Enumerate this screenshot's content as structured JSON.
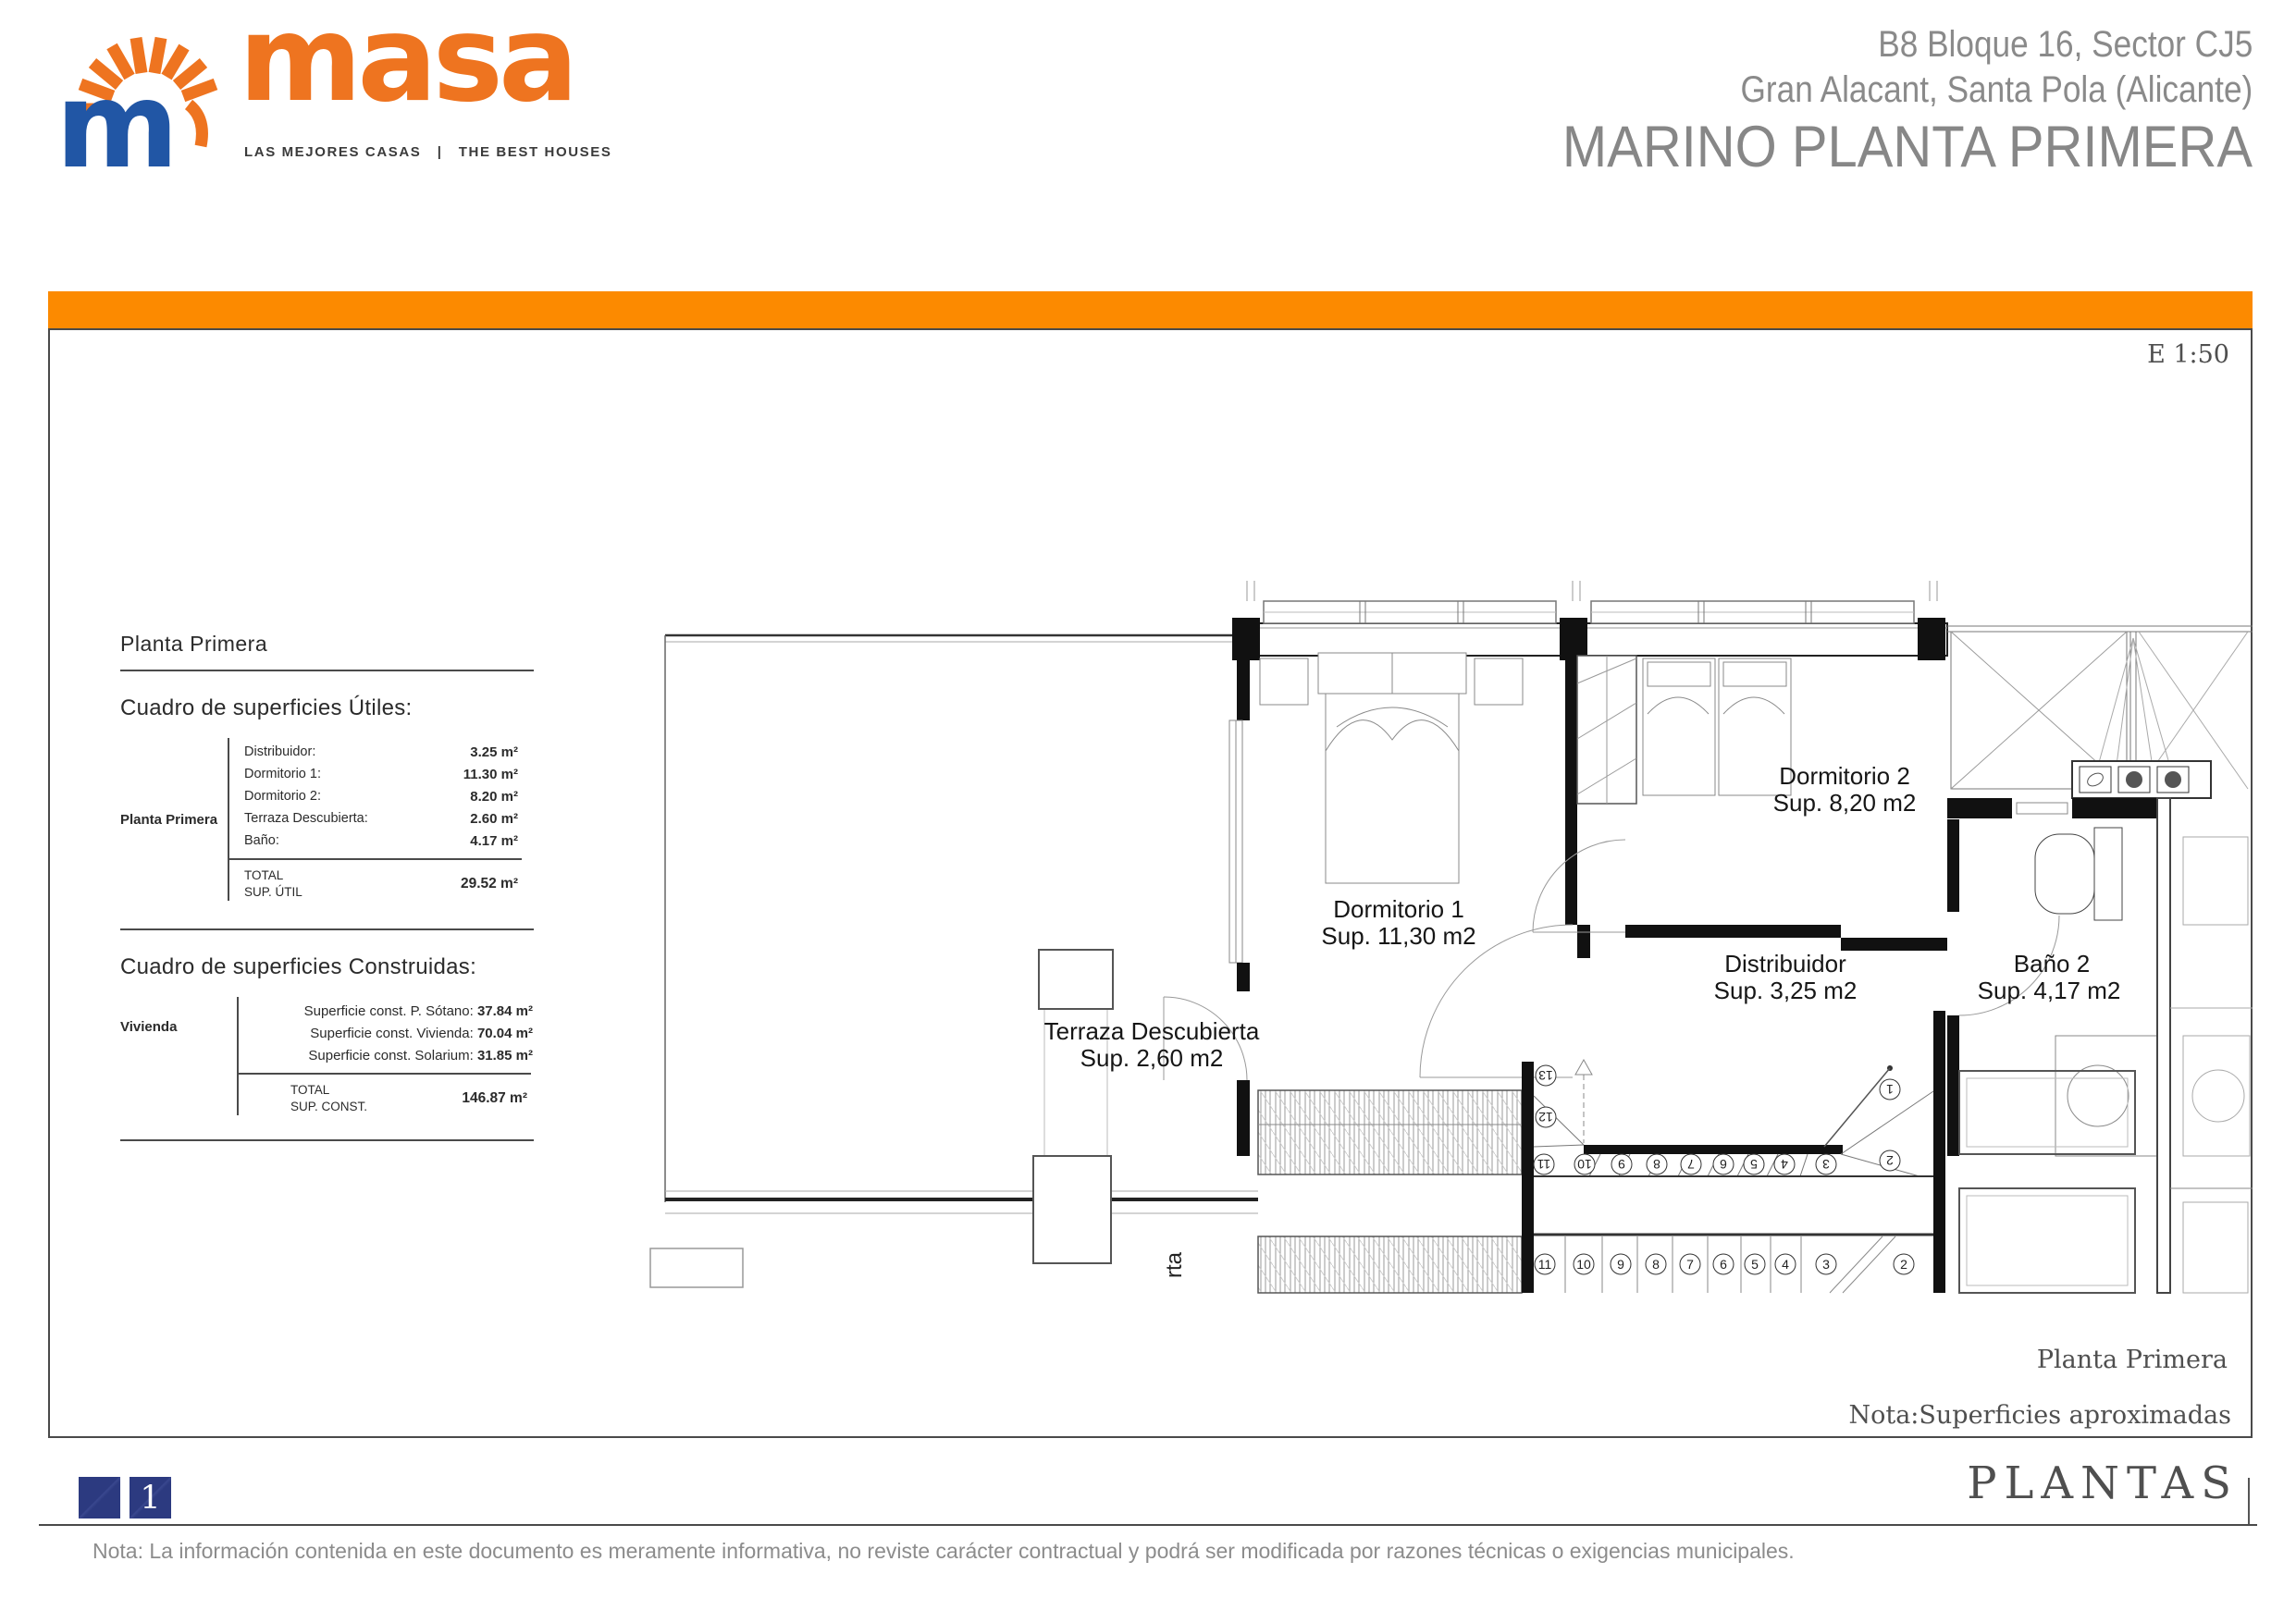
{
  "header": {
    "brand": "masa",
    "tagline": "LAS MEJORES CASAS   |   THE BEST HOUSES",
    "project_line1": "B8 Bloque 16, Sector CJ5",
    "project_line2": "Gran Alacant, Santa Pola (Alicante)",
    "project_line3": "MARINO PLANTA PRIMERA"
  },
  "sheet": {
    "scale": "E 1:50",
    "panel": {
      "title": "Planta Primera",
      "useful": {
        "heading": "Cuadro de superficies Útiles:",
        "group_label": "Planta Primera",
        "rows": [
          {
            "label": "Distribuidor:",
            "value": "3.25 m²"
          },
          {
            "label": "Dormitorio 1:",
            "value": "11.30 m²"
          },
          {
            "label": "Dormitorio 2:",
            "value": "8.20 m²"
          },
          {
            "label": "Terraza Descubierta:",
            "value": "2.60 m²"
          },
          {
            "label": "Baño:",
            "value": "4.17 m²"
          }
        ],
        "total_label": "TOTAL",
        "total_sub": "SUP. ÚTIL",
        "total_value": "29.52 m²"
      },
      "built": {
        "heading": "Cuadro de superficies Construidas:",
        "group_label": "Vivienda",
        "rows": [
          {
            "label": "Superficie const. P. Sótano: ",
            "value": "37.84 m²"
          },
          {
            "label": "Superficie const. Vivienda: ",
            "value": "70.04 m²"
          },
          {
            "label": "Superficie const. Solarium: ",
            "value": "31.85 m²"
          }
        ],
        "total_label": "TOTAL",
        "total_sub": "SUP. CONST.",
        "total_value": "146.87 m²"
      }
    },
    "plan": {
      "rooms": {
        "dormitorio1": {
          "name": "Dormitorio 1",
          "area": "Sup. 11,30 m2"
        },
        "dormitorio2": {
          "name": "Dormitorio 2",
          "area": "Sup. 8,20 m2"
        },
        "distribuidor": {
          "name": "Distribuidor",
          "area": "Sup. 3,25 m2"
        },
        "bano2": {
          "name": "Baño 2",
          "area": "Sup. 4,17 m2"
        },
        "terraza": {
          "name": "Terraza Descubierta",
          "area": "Sup. 2,60 m2"
        }
      },
      "stair_upper": [
        "13",
        "12",
        "11",
        "10",
        "9",
        "8",
        "7",
        "6",
        "5",
        "4",
        "3",
        "2",
        "1"
      ],
      "stair_lower": [
        "11",
        "10",
        "9",
        "8",
        "7",
        "6",
        "5",
        "4",
        "3",
        "2"
      ],
      "clipped_text": "rta"
    },
    "caption": "Planta Primera",
    "note": "Nota:Superficies aproximadas"
  },
  "footer": {
    "page_number": "1",
    "sheet_title": "PLANTAS",
    "disclaimer": "Nota: La información contenida en este documento es meramente informativa, no reviste carácter contractual y podrá ser modificada por razones técnicas o exigencias municipales."
  },
  "colors": {
    "orange_bar": "#FC8A00",
    "logo_orange": "#EE7420",
    "logo_blue": "#2156A5",
    "navy_square": "#2C3A80",
    "header_gray": "#8A8A8A"
  }
}
